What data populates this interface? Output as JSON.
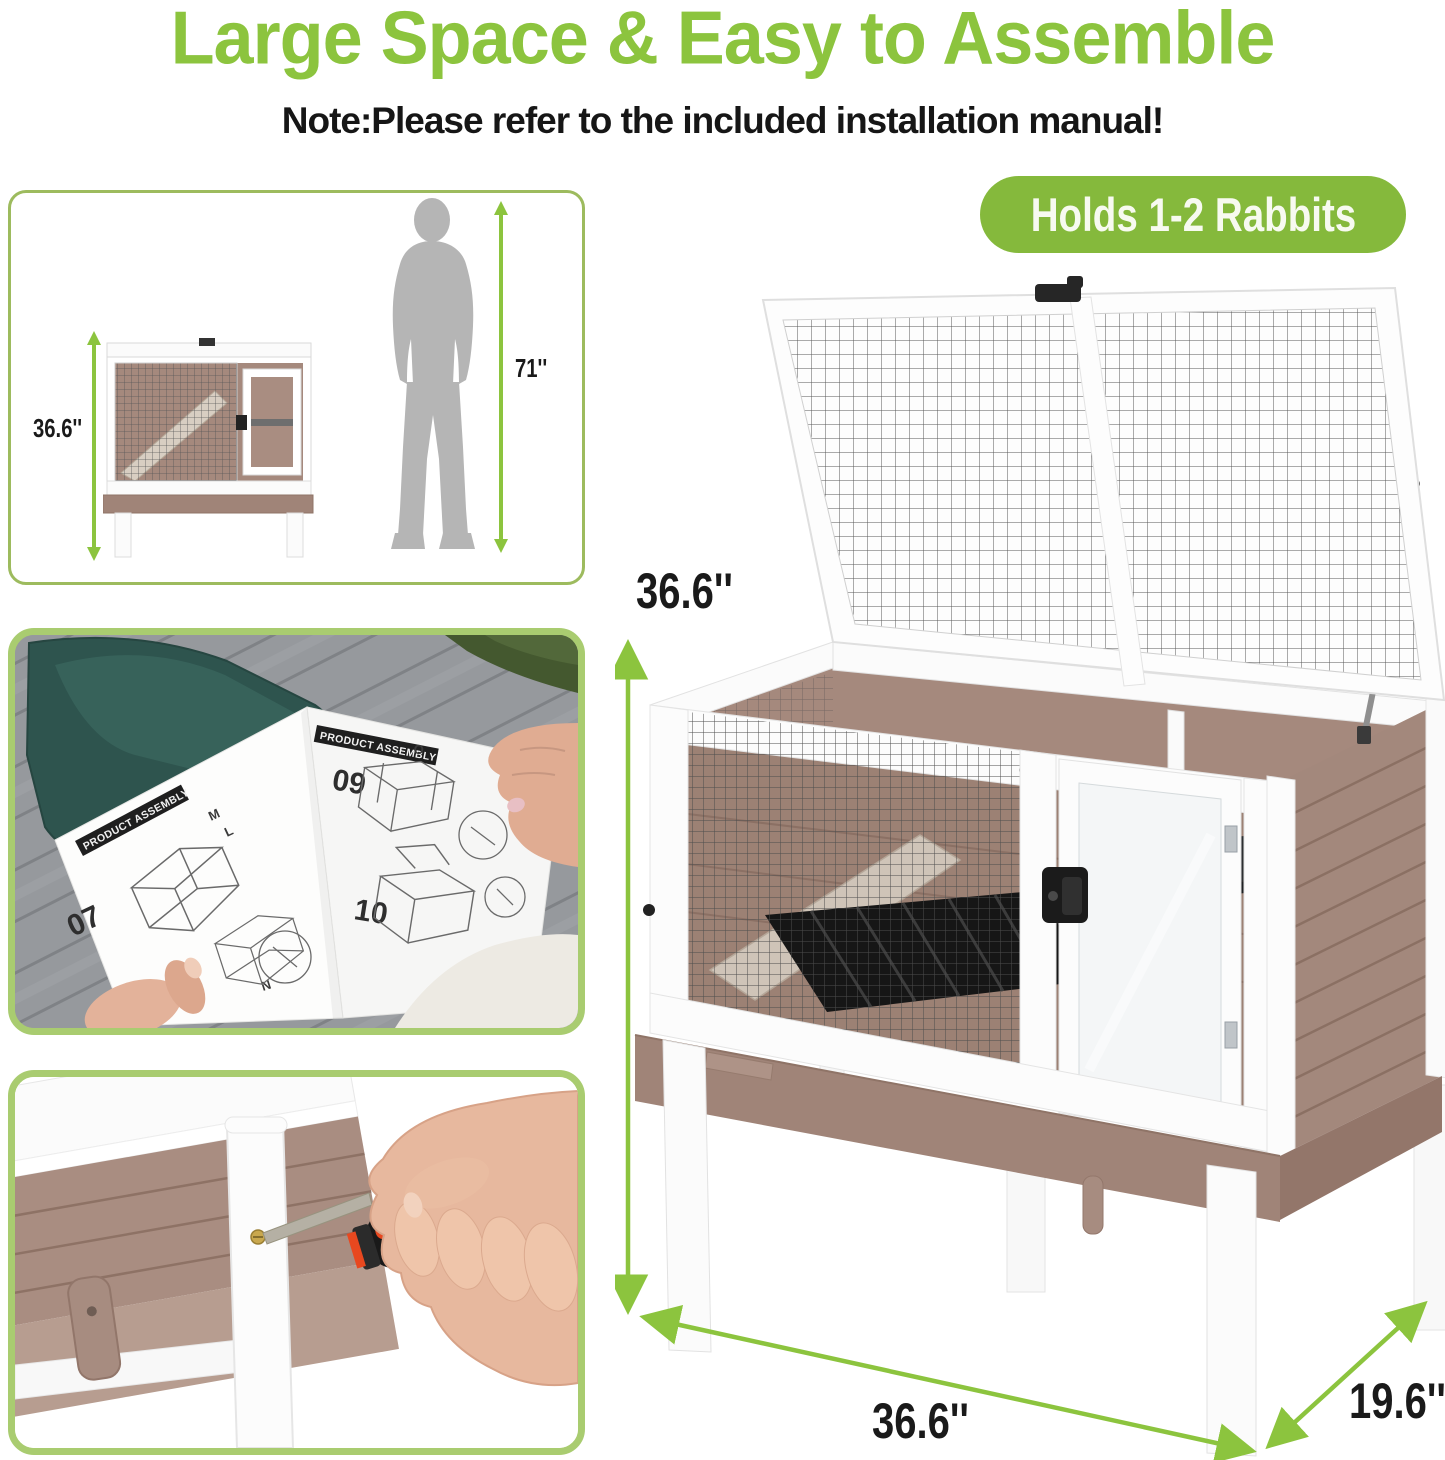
{
  "header": {
    "title": "Large Space & Easy to Assemble",
    "note": "Note:Please refer to the included installation manual!"
  },
  "badge": {
    "label": "Holds 1-2 Rabbits"
  },
  "size_compare": {
    "hutch_height": "36.6''",
    "person_height": "71''"
  },
  "dimensions": {
    "height": "36.6''",
    "width": "36.6''",
    "depth": "19.6''"
  },
  "manual": {
    "header_left": "PRODUCT ASSEMBLY",
    "header_right": "PRODUCT ASSEMBLY",
    "steps": [
      "07",
      "08",
      "09",
      "10"
    ],
    "part_labels": [
      "M",
      "L",
      "N",
      "O"
    ]
  },
  "colors": {
    "accent_green": "#8CC43E",
    "badge_green": "#85B93C",
    "panel_border_green": "#9DBB5E",
    "photo_border_green": "#A9CC70",
    "wood_brown": "#A98D81",
    "apron_brown": "#A08478",
    "silhouette_gray": "#B5B5B5",
    "tray_black": "#161616",
    "text_black": "#1A1A1A",
    "badge_text": "#F7FAF0"
  }
}
